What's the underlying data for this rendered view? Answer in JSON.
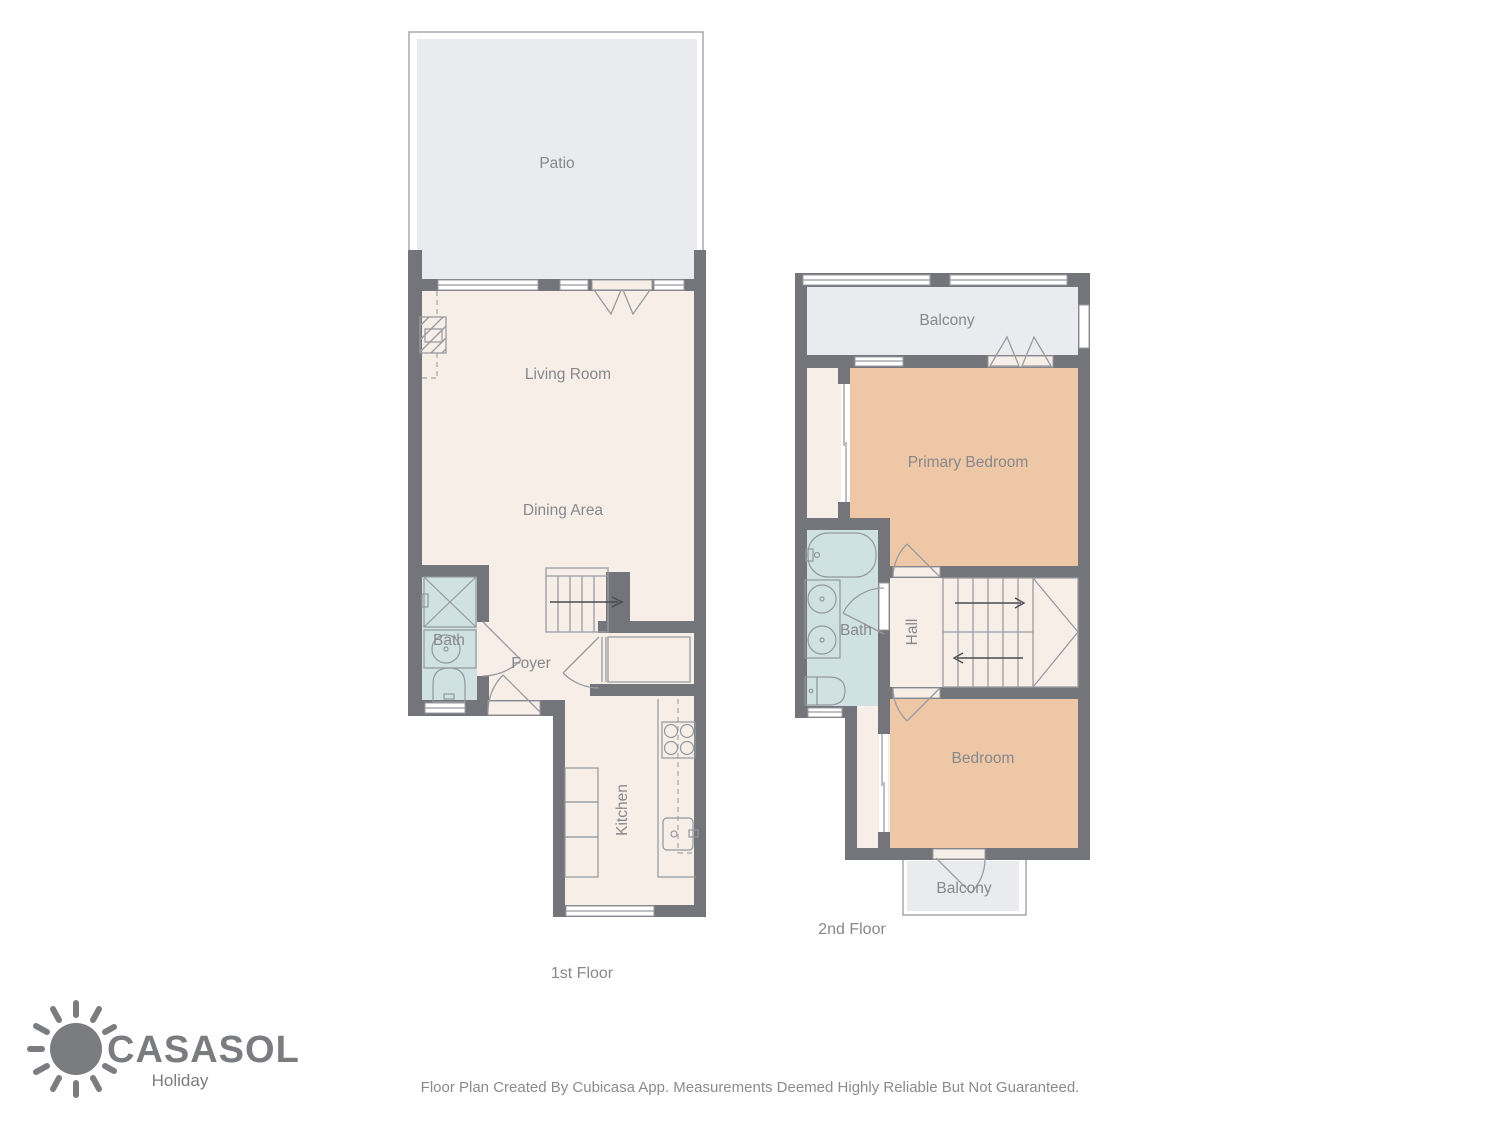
{
  "floor1": {
    "caption": "1st Floor",
    "rooms": {
      "patio": "Patio",
      "living_room": "Living Room",
      "dining_area": "Dining Area",
      "bath": "Bath",
      "foyer": "Foyer",
      "kitchen": "Kitchen"
    }
  },
  "floor2": {
    "caption": "2nd Floor",
    "rooms": {
      "balcony_top": "Balcony",
      "primary_bedroom": "Primary Bedroom",
      "bath": "Bath",
      "hall": "Hall",
      "bedroom": "Bedroom",
      "balcony_bottom": "Balcony"
    }
  },
  "branding": {
    "name": "CASASOL",
    "tagline": "Holiday"
  },
  "footer": {
    "disclaimer": "Floor Plan Created By Cubicasa App. Measurements Deemed Highly Reliable But Not Guaranteed."
  },
  "colors": {
    "wall": "#74757a",
    "outdoor": "#e9ebee",
    "room": "#f7eee8",
    "bedroom": "#eec8a6",
    "bath": "#cfe1e3",
    "line": "#9a9ba0",
    "text": "#87888c",
    "logo": "#7b7c80",
    "footer_text": "#8b8b8b"
  }
}
